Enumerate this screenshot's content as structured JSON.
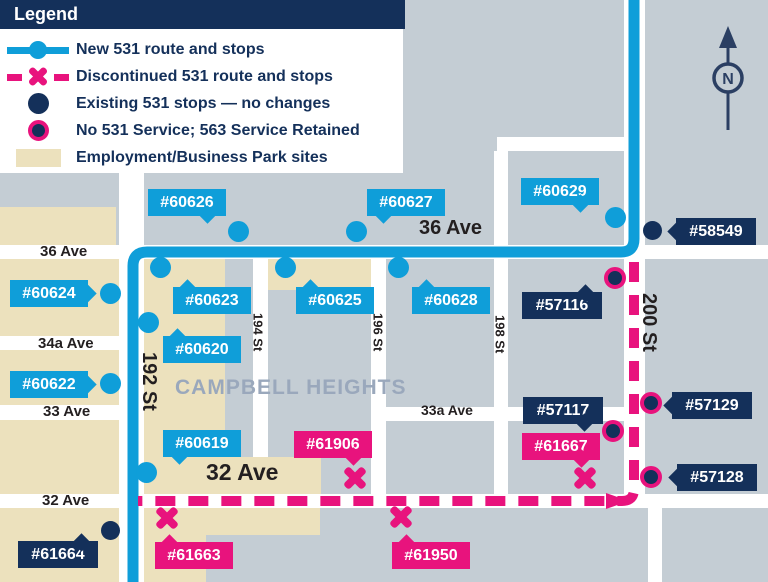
{
  "colors": {
    "navy": "#14305a",
    "blue": "#0f9ed9",
    "pink": "#e8137d",
    "beige": "#ece1bd",
    "bg": "#c4cdd4",
    "street": "#ffffff",
    "black": "#231f20",
    "area": "#9aa8bc"
  },
  "legend": {
    "title": "Legend",
    "items": [
      {
        "icon": "new-route-icon",
        "label": "New 531 route and stops"
      },
      {
        "icon": "discontinued-route-icon",
        "label": "Discontinued 531 route and stops"
      },
      {
        "icon": "existing-stop-icon",
        "label": "Existing 531 stops — no changes"
      },
      {
        "icon": "no-service-stop-icon",
        "label": "No 531 Service; 563 Service Retained"
      },
      {
        "icon": "business-park-icon",
        "label": "Employment/Business Park sites"
      }
    ]
  },
  "compass": {
    "label": "N"
  },
  "map": {
    "area_label": "CAMPBELL HEIGHTS",
    "blocks": [
      {
        "x": 0,
        "y": 207,
        "w": 116,
        "h": 38
      },
      {
        "x": 0,
        "y": 259,
        "w": 119,
        "h": 77
      },
      {
        "x": 0,
        "y": 350,
        "w": 119,
        "h": 55
      },
      {
        "x": 0,
        "y": 420,
        "w": 119,
        "h": 74
      },
      {
        "x": 0,
        "y": 508,
        "w": 119,
        "h": 74
      },
      {
        "x": 144,
        "y": 259,
        "w": 81,
        "h": 198
      },
      {
        "x": 268,
        "y": 259,
        "w": 103,
        "h": 31
      },
      {
        "x": 133,
        "y": 457,
        "w": 188,
        "h": 37
      },
      {
        "x": 140,
        "y": 508,
        "w": 180,
        "h": 27
      },
      {
        "x": 140,
        "y": 508,
        "w": 66,
        "h": 74
      }
    ],
    "streets": [
      {
        "name": "36 Ave",
        "x": 0,
        "y": 245,
        "w": 768,
        "h": 14
      },
      {
        "name": "spur",
        "x": 497,
        "y": 137,
        "w": 148,
        "h": 14
      },
      {
        "name": "34a Ave",
        "x": 0,
        "y": 336,
        "w": 144,
        "h": 14
      },
      {
        "name": "33 Ave",
        "x": 0,
        "y": 405,
        "w": 144,
        "h": 15
      },
      {
        "name": "33a Ave",
        "x": 380,
        "y": 407,
        "w": 262,
        "h": 14
      },
      {
        "name": "32 Ave",
        "x": 0,
        "y": 494,
        "w": 768,
        "h": 14
      },
      {
        "name": "192 St",
        "x": 119,
        "y": 170,
        "w": 25,
        "h": 412
      },
      {
        "name": "194 St",
        "x": 253,
        "y": 245,
        "w": 15,
        "h": 212
      },
      {
        "name": "196 St",
        "x": 371,
        "y": 245,
        "w": 15,
        "h": 249
      },
      {
        "name": "198 St",
        "x": 494,
        "y": 151,
        "w": 14,
        "h": 343
      },
      {
        "name": "200 St",
        "x": 624,
        "y": 0,
        "w": 21,
        "h": 508
      },
      {
        "name": "200 St south",
        "x": 648,
        "y": 508,
        "w": 14,
        "h": 74
      }
    ],
    "street_labels": [
      {
        "text": "36 Ave",
        "x": 40,
        "y": 244,
        "size": 15
      },
      {
        "text": "36 Ave",
        "x": 419,
        "y": 218,
        "size": 20
      },
      {
        "text": "34a Ave",
        "x": 38,
        "y": 336,
        "size": 15
      },
      {
        "text": "33 Ave",
        "x": 43,
        "y": 404,
        "size": 15
      },
      {
        "text": "33a Ave",
        "x": 421,
        "y": 403,
        "size": 14
      },
      {
        "text": "32 Ave",
        "x": 42,
        "y": 493,
        "size": 15
      },
      {
        "text": "32 Ave",
        "x": 206,
        "y": 460,
        "size": 23
      },
      {
        "text": "192 St",
        "x": 138,
        "y": 352,
        "size": 20,
        "rot": 90
      },
      {
        "text": "194 St",
        "x": 251,
        "y": 313,
        "size": 13,
        "rot": 90
      },
      {
        "text": "196 St",
        "x": 371,
        "y": 313,
        "size": 13,
        "rot": 90
      },
      {
        "text": "198 St",
        "x": 493,
        "y": 315,
        "size": 13,
        "rot": 90
      },
      {
        "text": "200 St",
        "x": 638,
        "y": 293,
        "size": 20,
        "rot": 90
      }
    ],
    "routes": {
      "new_route": {
        "path": "M 634 0 L 634 239 Q 634 252 621 252 L 147 252 Q 133 252 133 266 L 133 582",
        "width": 11
      },
      "discontinued_route": {
        "path": "M 634 262 L 634 489 Q 634 501 622 501 L 138 501",
        "width": 10,
        "dash": "20 13"
      },
      "discontinued_corner_arrow": "606,493 629,501 606,509"
    },
    "stops": [
      {
        "id": "#60626",
        "type": "new",
        "tag": [
          148,
          189
        ],
        "ptr": "br",
        "marker": [
          238,
          231
        ]
      },
      {
        "id": "#60627",
        "type": "new",
        "tag": [
          367,
          189
        ],
        "ptr": "bl",
        "marker": [
          356,
          231
        ]
      },
      {
        "id": "#60629",
        "type": "new",
        "tag": [
          521,
          178
        ],
        "ptr": "br",
        "marker": [
          615,
          217
        ]
      },
      {
        "id": "#60624",
        "type": "new",
        "tag": [
          10,
          280
        ],
        "ptr": "r",
        "marker": [
          110,
          293
        ]
      },
      {
        "id": "#60623",
        "type": "new",
        "tag": [
          173,
          287
        ],
        "ptr": "tl",
        "marker": [
          160,
          267
        ]
      },
      {
        "id": "#60625",
        "type": "new",
        "tag": [
          296,
          287
        ],
        "ptr": "tl",
        "marker": [
          285,
          267
        ]
      },
      {
        "id": "#60628",
        "type": "new",
        "tag": [
          412,
          287
        ],
        "ptr": "tl",
        "marker": [
          398,
          267
        ]
      },
      {
        "id": "#60620",
        "type": "new",
        "tag": [
          163,
          336
        ],
        "ptr": "tl",
        "marker": [
          148,
          322
        ]
      },
      {
        "id": "#60622",
        "type": "new",
        "tag": [
          10,
          371
        ],
        "ptr": "r",
        "marker": [
          110,
          383
        ]
      },
      {
        "id": "#60619",
        "type": "new",
        "tag": [
          163,
          430
        ],
        "ptr": "bl",
        "marker": [
          146,
          472
        ]
      },
      {
        "id": "#58549",
        "type": "existing",
        "tag": [
          676,
          218
        ],
        "ptr": "l",
        "marker": [
          652,
          230
        ]
      },
      {
        "id": "#61664",
        "type": "existing",
        "tag": [
          18,
          541
        ],
        "ptr": "tr",
        "marker": [
          110,
          530
        ]
      },
      {
        "id": "#57116",
        "type": "no531",
        "tag": [
          522,
          292
        ],
        "ptr": "tr",
        "marker": [
          615,
          278
        ]
      },
      {
        "id": "#57117",
        "type": "no531",
        "tag": [
          523,
          397
        ],
        "ptr": "br",
        "marker": [
          613,
          431
        ]
      },
      {
        "id": "#57129",
        "type": "no531",
        "tag": [
          672,
          392
        ],
        "ptr": "l",
        "marker": [
          651,
          403
        ]
      },
      {
        "id": "#57128",
        "type": "no531",
        "tag": [
          677,
          464
        ],
        "ptr": "l",
        "marker": [
          651,
          477
        ]
      },
      {
        "id": "#61906",
        "type": "discontinued",
        "tag": [
          294,
          431
        ],
        "ptr": "br",
        "marker": [
          355,
          478
        ]
      },
      {
        "id": "#61667",
        "type": "discontinued",
        "tag": [
          522,
          433
        ],
        "ptr": "br",
        "marker": [
          585,
          478
        ]
      },
      {
        "id": "#61663",
        "type": "discontinued",
        "tag": [
          155,
          542
        ],
        "ptr": "tl",
        "marker": [
          167,
          518
        ]
      },
      {
        "id": "#61950",
        "type": "discontinued",
        "tag": [
          392,
          542
        ],
        "ptr": "tl",
        "marker": [
          401,
          517
        ]
      }
    ]
  }
}
